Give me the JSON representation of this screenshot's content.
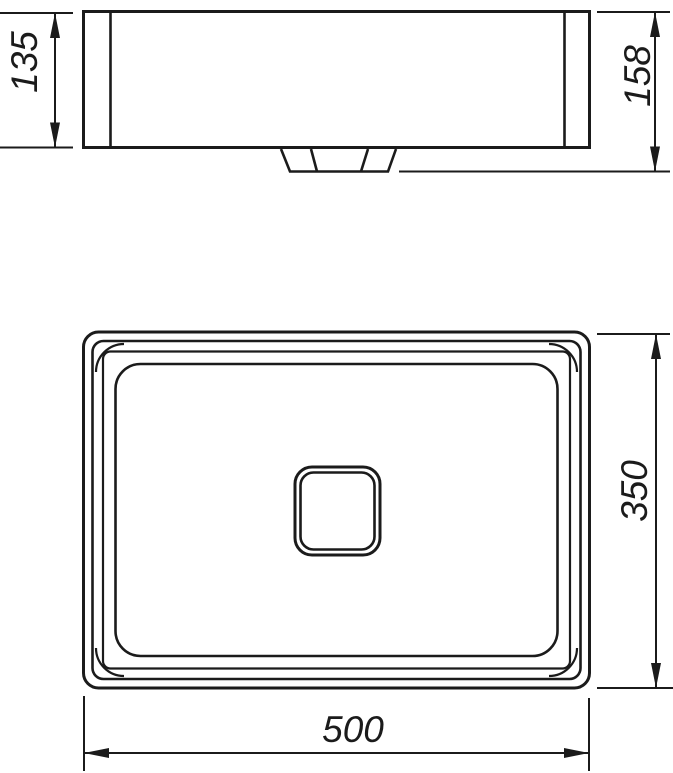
{
  "page": {
    "background": "#ffffff"
  },
  "drawing": {
    "kind": "sink-dimension-drawing",
    "line_color": "#1b1b1b",
    "views": {
      "side_view": {
        "features": [
          "basin-body",
          "left-wall-line",
          "right-wall-line",
          "drain-fitting"
        ]
      },
      "plan_view": {
        "features": [
          "outer-rim",
          "rim-inner-edge",
          "bowl-top-edge",
          "bowl-bottom-edge",
          "corner-radius-arcs",
          "drain-square"
        ]
      }
    },
    "dimensions": {
      "side_height": {
        "value": "135",
        "orientation": "vertical"
      },
      "side_overall_height": {
        "value": "158",
        "orientation": "vertical"
      },
      "plan_depth": {
        "value": "350",
        "orientation": "vertical"
      },
      "plan_width": {
        "value": "500",
        "orientation": "horizontal"
      }
    }
  }
}
